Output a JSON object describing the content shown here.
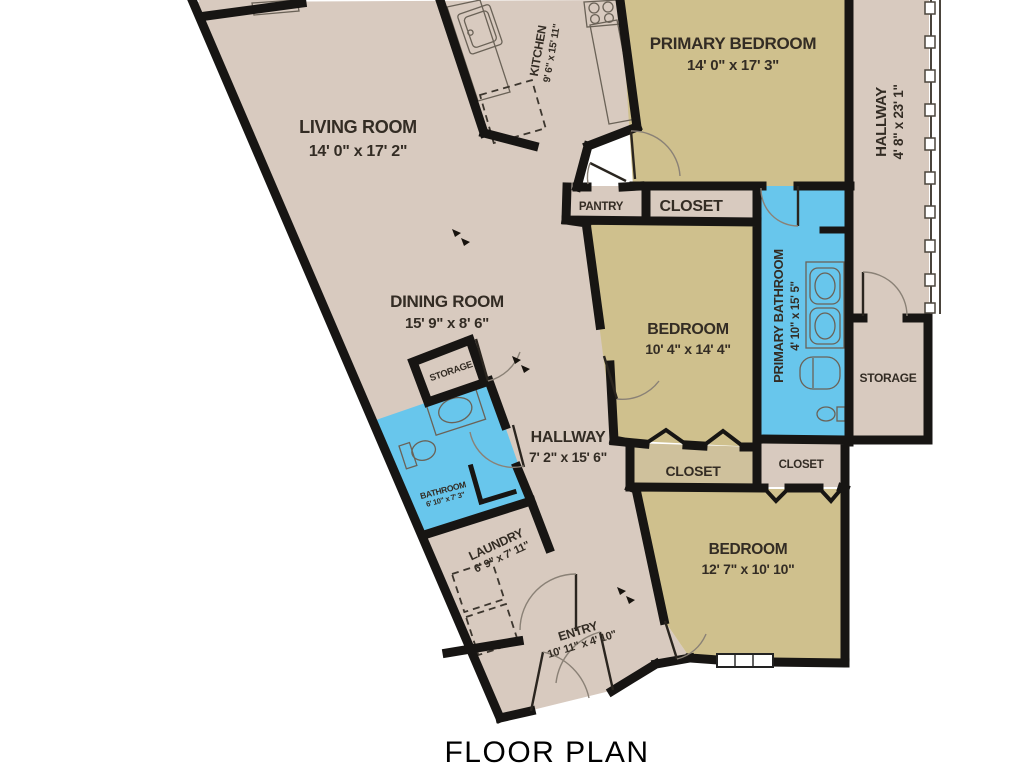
{
  "title": "FLOOR PLAN",
  "colors": {
    "floor": "#d8cabf",
    "bedroom": "#cfc08d",
    "closet": "#cfc19c",
    "bath": "#68c6ec",
    "wall": "#171513",
    "label_text": "#332c24"
  },
  "rooms": {
    "living": {
      "name": "LIVING ROOM",
      "dims": "14' 0\" x 17' 2\""
    },
    "kitchen": {
      "name": "KITCHEN",
      "dims": "9' 6\" x 15' 11\""
    },
    "primary_bedroom": {
      "name": "PRIMARY BEDROOM",
      "dims": "14' 0\" x 17' 3\""
    },
    "hallway_right": {
      "name": "HALLWAY",
      "dims": "4' 8\" x 23' 1\""
    },
    "pantry": {
      "name": "PANTRY"
    },
    "closet_top": {
      "name": "CLOSET"
    },
    "dining": {
      "name": "DINING ROOM",
      "dims": "15' 9\" x 8' 6\""
    },
    "bedroom_mid": {
      "name": "BEDROOM",
      "dims": "10' 4\" x 14' 4\""
    },
    "primary_bath": {
      "name": "PRIMARY BATHROOM",
      "dims": "4' 10\" x 15' 5\""
    },
    "storage_right": {
      "name": "STORAGE"
    },
    "storage_small": {
      "name": "STORAGE"
    },
    "hallway_main": {
      "name": "HALLWAY",
      "dims": "7' 2\" x 15' 6\""
    },
    "bathroom": {
      "name": "BATHROOM",
      "dims": "6' 10\" x 7' 3\""
    },
    "closet_left": {
      "name": "CLOSET"
    },
    "closet_right": {
      "name": "CLOSET"
    },
    "laundry": {
      "name": "LAUNDRY",
      "dims": "6' 9\" x 7' 11\""
    },
    "bedroom_bottom": {
      "name": "BEDROOM",
      "dims": "12' 7\" x 10' 10\""
    },
    "entry": {
      "name": "ENTRY",
      "dims": "10' 11\" x 4' 10\""
    }
  }
}
